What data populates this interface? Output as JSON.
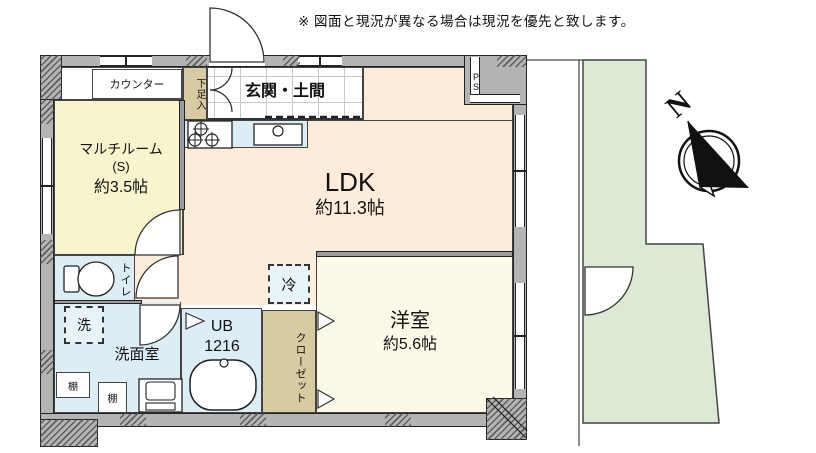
{
  "disclaimer": "※ 図面と現況が異なる場合は現況を優先と致します。",
  "plan": {
    "rooms": {
      "multi_room": {
        "name": "マルチルーム",
        "annex": "(S)",
        "area": "約3.5帖"
      },
      "entrance": {
        "name": "玄関・土間"
      },
      "ldk": {
        "name": "LDK",
        "area": "約11.3帖"
      },
      "western_room": {
        "name": "洋室",
        "area": "約5.6帖"
      },
      "toilet": {
        "name": "トイレ"
      },
      "washroom": {
        "name": "洗面室"
      },
      "unit_bath": {
        "name": "UB",
        "size": "1216"
      },
      "closet": {
        "name": "クローゼット"
      },
      "private_garden": {
        "name": "専用庭",
        "area": "10.19m²"
      }
    },
    "labels": {
      "counter": "カウンター",
      "shoe_cabinet": "下足入",
      "refrigerator_space": "冷",
      "washer_space": "洗",
      "shelf_a": "棚",
      "shelf_b": "棚",
      "pipe_space": "PS"
    },
    "compass": {
      "north": "N"
    },
    "colors": {
      "ldk_floor": "#fcecd9",
      "multi_room_floor": "#f8f4cd",
      "western_room_floor": "#fdf9e9",
      "wet_area_floor": "#ddedf5",
      "closet_floor": "#d8cba2",
      "garden": "#dce9d4",
      "wall": "#b4b4b4"
    }
  }
}
